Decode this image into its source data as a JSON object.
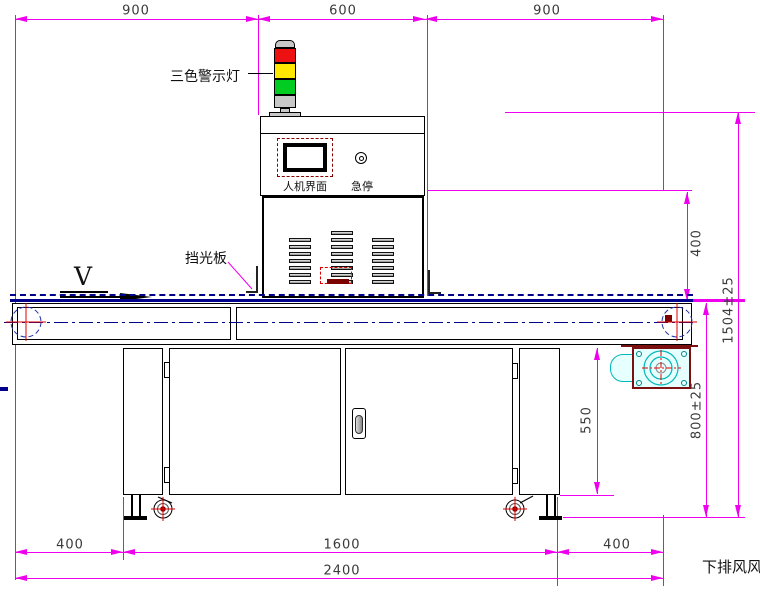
{
  "drawing": {
    "direction_label": "V",
    "annotations": {
      "warning_light": "三色警示灯",
      "hmi": "人机界面",
      "estop": "急停",
      "light_shield": "挡光板",
      "bottom_exhaust": "下排风风"
    },
    "dims": {
      "top": [
        "900",
        "600",
        "900"
      ],
      "right": {
        "lamp_section": "400",
        "overall_height": "1504±25",
        "belt_height": "800±25",
        "cabinet_height": "550"
      },
      "bottom": {
        "left_offset": "400",
        "center_span": "1600",
        "right_offset": "400",
        "overall_length": "2400"
      }
    },
    "colors": {
      "dimension": "#ee00ee",
      "outline": "#000000",
      "belt": "#00008b",
      "fan": "#00b8b8",
      "alarm_red": "#ee1111",
      "alarm_yellow": "#ffe800",
      "alarm_green": "#00cc22"
    }
  }
}
